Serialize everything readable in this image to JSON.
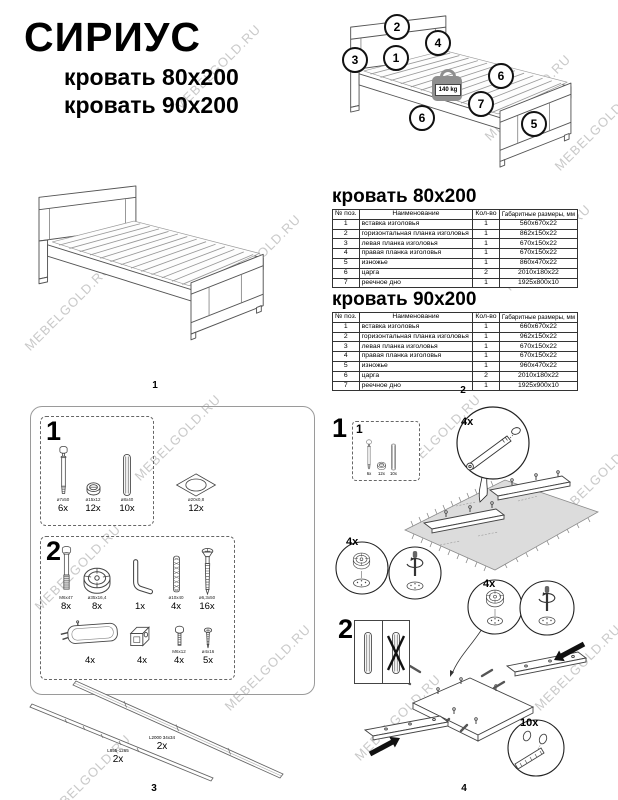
{
  "watermark": {
    "text": "MEBELGOLD.RU"
  },
  "header": {
    "title": "СИРИУС",
    "subtitle_80": "кровать 80x200",
    "subtitle_90": "кровать 90x200"
  },
  "overview": {
    "weight_label": "140 kg",
    "callouts": [
      "2",
      "4",
      "1",
      "3",
      "6",
      "7",
      "6",
      "5"
    ]
  },
  "table_headers": [
    "№ поз.",
    "Наименование",
    "Кол-во",
    "Габаритные размеры, мм"
  ],
  "tables": [
    {
      "title": "кровать 80x200",
      "rows": [
        {
          "pos": "1",
          "name": "вставка изголовья",
          "qty": "1",
          "size": "560х670х22"
        },
        {
          "pos": "2",
          "name": "горизонтальная планка изголовья",
          "qty": "1",
          "size": "862х150х22"
        },
        {
          "pos": "3",
          "name": "левая планка изголовья",
          "qty": "1",
          "size": "670х150х22"
        },
        {
          "pos": "4",
          "name": "правая планка изголовья",
          "qty": "1",
          "size": "670х150х22"
        },
        {
          "pos": "5",
          "name": "изножье",
          "qty": "1",
          "size": "860х470х22"
        },
        {
          "pos": "6",
          "name": "царга",
          "qty": "2",
          "size": "2010х180х22"
        },
        {
          "pos": "7",
          "name": "реечное дно",
          "qty": "1",
          "size": "1925х800х10"
        }
      ]
    },
    {
      "title": "кровать 90x200",
      "rows": [
        {
          "pos": "1",
          "name": "вставка изголовья",
          "qty": "1",
          "size": "660х670х22"
        },
        {
          "pos": "2",
          "name": "горизонтальная планка изголовья",
          "qty": "1",
          "size": "962х150х22"
        },
        {
          "pos": "3",
          "name": "левая планка изголовья",
          "qty": "1",
          "size": "670х150х22"
        },
        {
          "pos": "4",
          "name": "правая планка изголовья",
          "qty": "1",
          "size": "670х150х22"
        },
        {
          "pos": "5",
          "name": "изножье",
          "qty": "1",
          "size": "960х470х22"
        },
        {
          "pos": "6",
          "name": "царга",
          "qty": "2",
          "size": "2010х180х22"
        },
        {
          "pos": "7",
          "name": "реечное дно",
          "qty": "1",
          "size": "1925х900х10"
        }
      ]
    }
  ],
  "pages": [
    "1",
    "2",
    "3",
    "4"
  ],
  "hardware": {
    "step1": {
      "num": "1",
      "items": [
        {
          "size": "ø7х50",
          "count": "6x"
        },
        {
          "size": "ø15х12",
          "count": "12x"
        },
        {
          "size": "ø8х40",
          "count": "10x"
        }
      ],
      "pad": {
        "size": "ø20х0,8",
        "count": "12x"
      }
    },
    "step2": {
      "num": "2",
      "row1": [
        {
          "size": "M6х47",
          "count": "8x"
        },
        {
          "size": "ø35х16,4",
          "count": "8x"
        },
        {
          "size": "",
          "count": "1x"
        },
        {
          "size": "ø10х40",
          "count": "4x"
        },
        {
          "size": "ø6,3х50",
          "count": "16x"
        }
      ],
      "row2": [
        {
          "size": "",
          "count": "4x"
        },
        {
          "size": "",
          "count": "4x"
        },
        {
          "size": "M6х12",
          "count": "4x"
        },
        {
          "size": "ø4х16",
          "count": "5x"
        }
      ]
    },
    "rails": [
      {
        "label": "L2000 34х34",
        "count": "2x"
      },
      {
        "label": "L855-1265",
        "count": "2x"
      }
    ]
  },
  "assembly": {
    "step1": {
      "num": "1",
      "box_num": "1",
      "box_counts": [
        "6x",
        "12x",
        "10x"
      ],
      "bolt_callout": "4x",
      "cam_callout": "4x"
    },
    "step2": {
      "num": "2",
      "cam_callout": "4x",
      "dowel_callout": "10x"
    }
  }
}
